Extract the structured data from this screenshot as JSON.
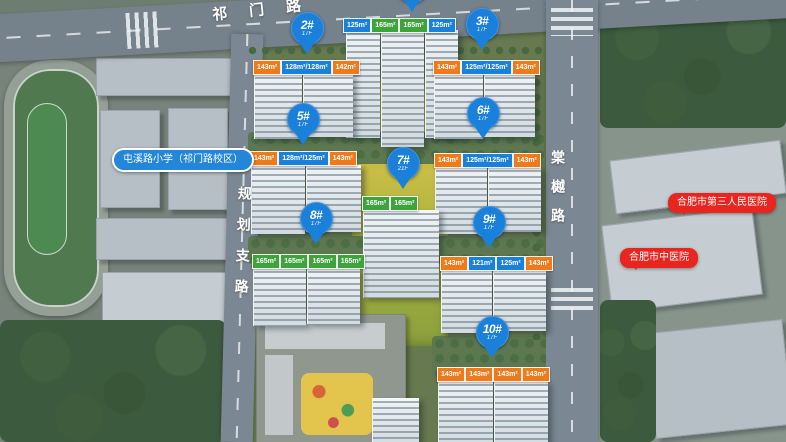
{
  "title": "residential-masterplan-aerial",
  "colors": {
    "pin_blue": "#1b80d9",
    "tag_orange": "#ef7a1c",
    "tag_blue": "#1b80d9",
    "tag_green": "#3fa33c",
    "school_label_blue": "#2486d8",
    "hospital_label_red": "#e8251f"
  },
  "roads": {
    "top": {
      "label": "祁门路"
    },
    "left": {
      "label": "规划支路"
    },
    "right": {
      "label": "棠樾路"
    }
  },
  "landmarks": {
    "school": {
      "label": "屯溪路小学（祁门路校区）"
    },
    "hospital_1": {
      "label": "合肥市第三人民医院"
    },
    "hospital_2": {
      "label": "合肥市中医院"
    }
  },
  "buildings": [
    {
      "badge": "",
      "floors": "",
      "tags": [
        "125m²",
        "165m²",
        "165m²",
        "125m²"
      ]
    },
    {
      "badge": "2#",
      "floors": "17F",
      "tags": [
        "143m²",
        "128m²/128m²",
        "142m²"
      ]
    },
    {
      "badge": "3#",
      "floors": "17F",
      "tags": [
        "143m²",
        "125m²/125m²",
        "143m²"
      ]
    },
    {
      "badge": "5#",
      "floors": "17F",
      "tags": [
        "143m²",
        "128m²/125m²",
        "143m²"
      ]
    },
    {
      "badge": "6#",
      "floors": "17F",
      "tags": [
        "143m²",
        "125m²/125m²",
        "143m²"
      ]
    },
    {
      "badge": "7#",
      "floors": "21F",
      "tags": [
        "165m²",
        "165m²"
      ]
    },
    {
      "badge": "8#",
      "floors": "17F",
      "tags": [
        "165m²",
        "165m²",
        "165m²",
        "165m²"
      ]
    },
    {
      "badge": "9#",
      "floors": "17F",
      "tags": [
        "143m²",
        "121m²",
        "125m²",
        "143m²"
      ]
    },
    {
      "badge": "10#",
      "floors": "17F",
      "tags": [
        "143m²",
        "143m²",
        "143m²",
        "143m²"
      ]
    }
  ]
}
